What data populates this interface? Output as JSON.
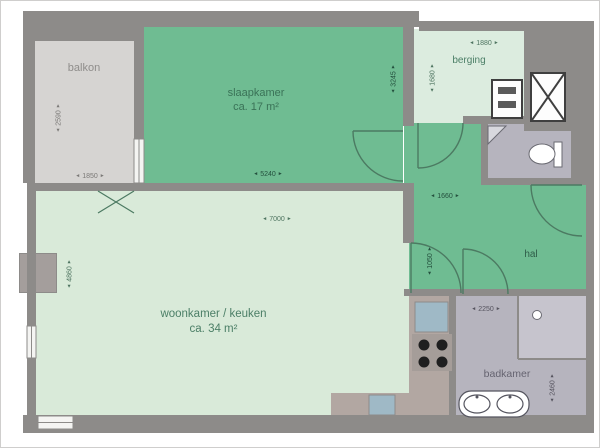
{
  "plan_type": "apartment-floor-plan",
  "rooms": {
    "balkon": {
      "label": "balkon"
    },
    "slaapkamer": {
      "label": "slaapkamer",
      "area": "ca. 17 m²"
    },
    "berging": {
      "label": "berging"
    },
    "hal": {
      "label": "hal"
    },
    "woonkamer": {
      "label": "woonkamer / keuken",
      "area": "ca. 34 m²"
    },
    "badkamer": {
      "label": "badkamer"
    }
  },
  "dimensions": {
    "balkon_w": "1850",
    "balkon_h": "2590",
    "slaapkamer_w": "5240",
    "slaapkamer_h": "3245",
    "berging_w": "1880",
    "berging_h": "1680",
    "hal_w": "1660",
    "hal_h": "1050",
    "woonkamer_w": "7000",
    "woonkamer_h": "4860",
    "badkamer_w": "2250",
    "badkamer_h": "2460"
  },
  "colors": {
    "room_green": "#6fbc92",
    "room_light_green": "#d9ead9",
    "berging_green": "#dcecdf",
    "balcony_gray": "#d6d4d2",
    "bath_gray": "#b6b4be",
    "wall_gray": "#8d8b89",
    "counter_taupe": "#b2a7a2",
    "fixture_blue": "#9fb9c6"
  },
  "icons": {
    "shaft": "box-with-x-cross",
    "meter_cabinet": "box-with-two-bars",
    "toilet": "bowl-with-cistern",
    "corner_basin": "corner-triangle",
    "shower": "divided-corner-with-head",
    "cooktop": "four-burner-dots",
    "kitchen_sink": "blue-square",
    "appliance": "blue-square",
    "double_washbasin": "two-ovals",
    "door": "quarter-arc",
    "window": "white-gap-with-line",
    "column": "gray-block"
  }
}
